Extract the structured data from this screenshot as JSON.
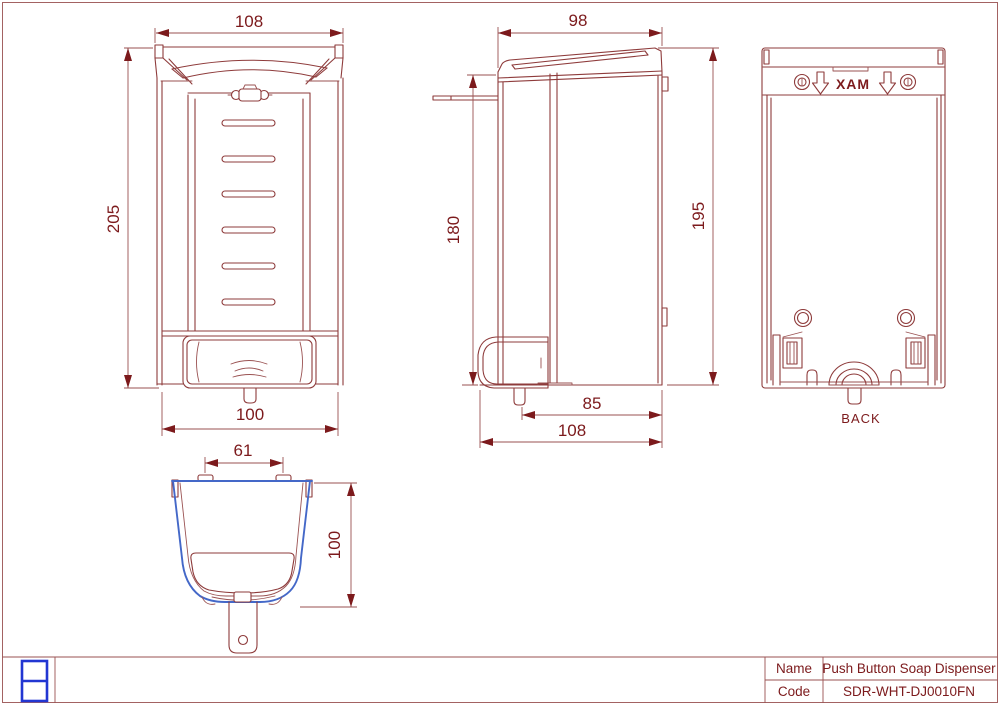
{
  "drawing": {
    "front_view": {
      "dim_width_top": "108",
      "dim_height": "205",
      "dim_width_bottom": "100"
    },
    "side_view": {
      "dim_depth_top": "98",
      "dim_front_height": "180",
      "dim_back_height": "195",
      "dim_nozzle_depth": "85",
      "dim_total_depth": "108"
    },
    "back_view": {
      "max_label": "XAM",
      "caption": "BACK"
    },
    "top_view": {
      "dim_slot_width": "61",
      "dim_depth": "100"
    }
  },
  "title_block": {
    "name_label": "Name",
    "name_value": "Push Button Soap Dispenser",
    "code_label": "Code",
    "code_value": "SDR-WHT-DJ0010FN"
  },
  "colors": {
    "line": "#8e3b3b",
    "dimension": "#7c1a1c",
    "outline_blue": "#4468c8",
    "logo_blue": "#2236d2",
    "background": "#ffffff"
  }
}
